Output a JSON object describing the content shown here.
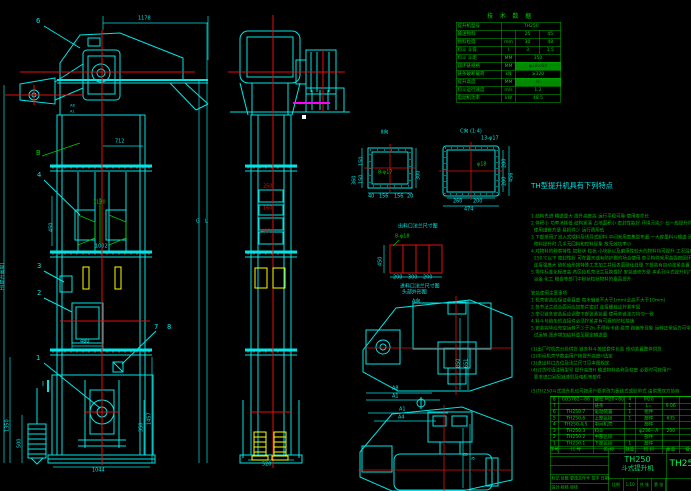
{
  "colors": {
    "cyan": "#00e5e5",
    "green": "#00c800",
    "red": "#e01010",
    "yellow": "#ffff00",
    "magenta": "#ff00ff",
    "bg": "#000000"
  },
  "tech": {
    "title": "技 术 数 据",
    "rows": [
      {
        "label": "提升机型号",
        "value": "TH250"
      },
      {
        "label": "输送物料",
        "unit": "",
        "v1": "25",
        "v2": "45"
      },
      {
        "label": "物料粒度",
        "unit": "mm",
        "v1": "30",
        "v2": "48"
      },
      {
        "label": "料斗 斗容",
        "unit": "l",
        "v1": "3",
        "v2": "1.5"
      },
      {
        "label": "料斗 斗距",
        "unit": "MM",
        "value": "350"
      },
      {
        "label": "圆环链规格",
        "unit": "MM",
        "value": "φ18×64"
      },
      {
        "label": "链条破断载荷",
        "unit": "kN",
        "value": "≥320"
      },
      {
        "label": "提升高度",
        "unit": "MM",
        "value": "H"
      },
      {
        "label": "料斗运行速度",
        "unit": "m/s",
        "value": "1.2"
      },
      {
        "label": "电动机功率",
        "unit": "kW",
        "value": "48.5"
      }
    ]
  },
  "features": {
    "title": "TH型提升机具有下列特点",
    "lines": [
      "1.结构先进 输送量大 提升高度高 运行平稳可靠 使用寿命长",
      "2.体积小 功率消耗低 结构紧凑 占地面积小 密封性能好 环境污染少 比一般提升机",
      "  使用维修方便 易损件少 运行费用低",
      "3.下部采用了流入式喂料及诱导式卸料 中间采用密集型布置 一大容量料斗输送 因而在",
      "  物料提升时 几乎无回料和挖料现象 故无效功率小",
      "4.对物料的种类特性 如粉状 粒状 小块状以及磨琢性较大的物料均可提升 工况温度要求在",
      "  250℃以下 密封性好 可在露天或有防护棚的场合使用 牵引构件采用高强度圆环链 与料斗",
      "  连接强度大 链轮齿形按特殊工艺加工并经表面硬化处理 下部装有自动张紧装置",
      "5.零件标准化程度高 各区段机壳法兰互换性好 安装维修方便 本系列斗式提升机广泛用于建材",
      "  冶金 化工 粮食等部门中粉状粒状物料的垂直提升",
      "",
      "安装使用注意事项",
      "1.机壳安装应保证垂直度 每米偏差不大于1mm(全高不大于10mm)",
      "2.各节法兰结合面间应加垫片密封 连接螺栓应拧紧牢固",
      "3.牵引链条安装后应调整下部张紧装置 使两条链张力均匀一致",
      "4.料斗与链条的连接件必须拧紧并有可靠的防松措施",
      "5.安装完毕应先空运转不少于2h 不得有卡链 碰壳 跑偏等现象 运转正常后方可带料",
      "  试运转 逐步增加给料量至额定输送量",
      "",
      "(1)出厂时机壳分段供货 链条料斗按成套件包装 传动装置整体供货",
      "(2)中间机壳节数由用户按提升高度H选定",
      "(3)进出料口方位及法兰尺寸见本图规定",
      "(4)订货时请注明型号 提升高度H 输送物料名称及粒度 必要时可按用户",
      "  要求进口另配减速机及电机等部件",
      "",
      "(5)TH250斗式提升机也可按用户要求改为板链式或胶带式 由供需双方协商"
    ]
  },
  "bom": {
    "rows": [
      {
        "no": "8",
        "code": "GB5782—86",
        "name": "螺栓 M20×80",
        "qty": "4",
        "mat": "M20",
        "wt": ""
      },
      {
        "no": "7",
        "code": "",
        "name": "链条",
        "qty": "1",
        "mat": "L=",
        "wt": "9.06"
      },
      {
        "no": "6",
        "code": "TH250.7",
        "name": "驱动装置",
        "qty": "1",
        "mat": "组件",
        "wt": ""
      },
      {
        "no": "5",
        "code": "TH250.6",
        "name": "上部区段",
        "qty": "1",
        "mat": "部件",
        "wt": "635"
      },
      {
        "no": "4",
        "code": "TH250.4,5",
        "name": "中间机壳",
        "qty": "",
        "mat": "部件",
        "wt": ""
      },
      {
        "no": "3",
        "code": "TH250.3",
        "name": "料斗",
        "qty": "",
        "mat": "φ236—A",
        "wt": "200"
      },
      {
        "no": "2",
        "code": "TH250.2",
        "name": "中部区段",
        "qty": "",
        "mat": "部件",
        "wt": ""
      },
      {
        "no": "1",
        "code": "TH250.1",
        "name": "下部区段",
        "qty": "1",
        "mat": "部件",
        "wt": ""
      }
    ],
    "header": {
      "no": "序号",
      "code": "代 号",
      "name": "名 称",
      "qty": "数量",
      "mat": "材 料",
      "wt": "重量",
      "note": "备注"
    }
  },
  "title_block": {
    "model": "TH250",
    "product": "斗式提升机",
    "drawing_no": "TH250",
    "rev_labels": "标记 处数 更改文件号 签字 日期",
    "sign_labels": "设计  校核  审核",
    "scale_label": "比例",
    "scale": "1:10",
    "sheet1": "共 张",
    "sheet2": "第 张"
  },
  "dims": {
    "d1178": "1178",
    "d712": "712",
    "d450": "450",
    "d1130": "1130",
    "d1002": "1002",
    "d480": "480",
    "d1044": "1044",
    "d1350": "1350",
    "d500": "500",
    "d1457": "1457",
    "d350": "350",
    "d520": "520",
    "d250": "250",
    "d160": "160",
    "d400": "400",
    "dH": "H(提升高度)",
    "dG": "G",
    "dL": "L",
    "dA8": "A8",
    "dA1": "A1",
    "f360": "360",
    "f150a": "150",
    "f150b": "150",
    "f300": "300",
    "f40a": "40",
    "f156a": "156",
    "f156b": "156",
    "f20": "20",
    "c260": "260",
    "c200": "200",
    "c474": "474",
    "c200a": "200",
    "c200b": "200",
    "c456": "456",
    "a450": "450",
    "a200a": "200",
    "a300": "300",
    "a200b": "200",
    "p850": "850",
    "p651": "651",
    "pA8": "A8",
    "pA1": "A1",
    "qA1": "A1",
    "qA4": "A4",
    "qB": "B",
    "qa": "a"
  },
  "balloons": {
    "b1": "1",
    "b2": "2",
    "b3": "3",
    "b4": "4",
    "b6": "6",
    "b7": "7",
    "b8": "8"
  },
  "marks": {
    "secI": "Ⅰ",
    "datumB": "B"
  },
  "labels": {
    "sec2": "Ⅱ向",
    "sec2_note": "8-φ17",
    "secC": "C向 (1:4)",
    "secC_note": "13-φ17",
    "secC_inner": "φ18",
    "anchor_title": "出料口法兰尺寸图",
    "anchor_note": "8-φ18",
    "outlet_caption": "进料口法兰尺寸图",
    "planA_title": "头部外形图",
    "planA_sub": "A向"
  }
}
